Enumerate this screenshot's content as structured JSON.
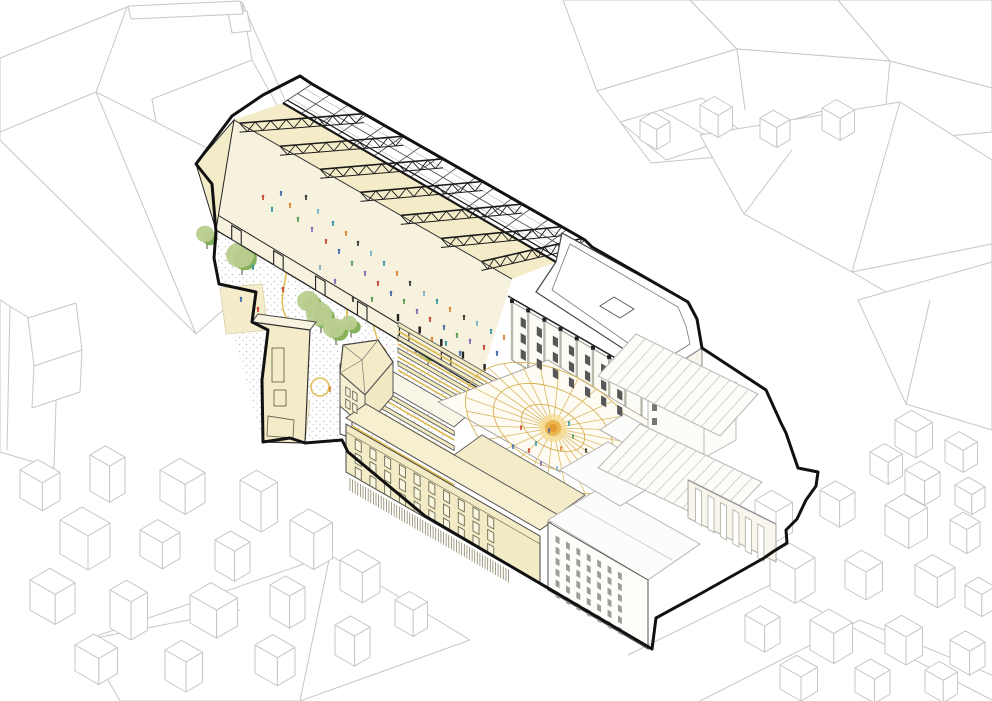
{
  "illustration": {
    "kind": "axonometric-architectural-cutaway",
    "subject": "market hall with open truss roof, public plaza, courtyard with radial canopy and theatre block inside a bold site boundary, surrounded by outline context buildings",
    "visible_text": "none"
  },
  "colors": {
    "ink": "#161616",
    "boundary": "#111111",
    "context_line": "#c7c7c7",
    "theatre_line": "#b8b8b8",
    "cream": "#f4ecc8",
    "cream_light": "#f8f3de",
    "cream_floor": "#f7f2dd",
    "facade_cream": "#f3ebc6",
    "window_frame": "#6a6a55",
    "window_dark": "#575757",
    "window_gray": "#9b9b9b",
    "stipple": "#c2c2c2",
    "tree_light": "#b9cd8f",
    "tree_dark": "#7fae53",
    "trunk": "#6b6b4f",
    "yellow": "#e3bf5c",
    "canopy": "#d8b052",
    "sun_core": "#e09a2f",
    "sun_mid": "#ecb64e",
    "sun_glow": "#f6dc8f"
  },
  "people_palette": [
    "#cc4b3b",
    "#3e9aa6",
    "#4a6fae",
    "#dd8a3a",
    "#5d9e56",
    "#3f3f3f",
    "#8a6fb2",
    "#7fb4c9"
  ],
  "people": {
    "market_hall": [
      [
        263,
        200
      ],
      [
        272,
        212
      ],
      [
        281,
        196
      ],
      [
        290,
        208
      ],
      [
        298,
        222
      ],
      [
        306,
        200
      ],
      [
        312,
        232
      ],
      [
        318,
        214
      ],
      [
        326,
        244
      ],
      [
        333,
        226
      ],
      [
        339,
        254
      ],
      [
        346,
        236
      ],
      [
        352,
        266
      ],
      [
        358,
        246
      ],
      [
        365,
        276
      ],
      [
        371,
        256
      ],
      [
        378,
        286
      ],
      [
        384,
        266
      ],
      [
        391,
        296
      ],
      [
        397,
        276
      ],
      [
        404,
        304
      ],
      [
        410,
        286
      ],
      [
        417,
        314
      ],
      [
        424,
        296
      ],
      [
        430,
        322
      ],
      [
        437,
        304
      ],
      [
        444,
        330
      ],
      [
        450,
        312
      ],
      [
        457,
        338
      ],
      [
        464,
        320
      ],
      [
        470,
        344
      ],
      [
        477,
        326
      ],
      [
        484,
        350
      ],
      [
        491,
        334
      ],
      [
        497,
        356
      ],
      [
        504,
        340
      ],
      [
        372,
        302
      ],
      [
        353,
        302
      ],
      [
        335,
        284
      ],
      [
        320,
        270
      ],
      [
        420,
        332
      ],
      [
        446,
        346
      ],
      [
        460,
        356
      ],
      [
        432,
        342
      ]
    ],
    "plaza": [
      [
        258,
        312
      ],
      [
        270,
        346
      ],
      [
        300,
        366
      ],
      [
        330,
        392
      ],
      [
        362,
        402
      ],
      [
        380,
        372
      ],
      [
        346,
        354
      ],
      [
        310,
        332
      ],
      [
        283,
        292
      ],
      [
        253,
        270
      ],
      [
        241,
        302
      ],
      [
        398,
        342
      ],
      [
        372,
        420
      ],
      [
        300,
        416
      ],
      [
        266,
        257
      ],
      [
        352,
        386
      ]
    ],
    "courtyard": [
      [
        521,
        430
      ],
      [
        536,
        446
      ],
      [
        549,
        433
      ],
      [
        561,
        451
      ],
      [
        573,
        439
      ],
      [
        586,
        453
      ],
      [
        541,
        466
      ],
      [
        557,
        471
      ],
      [
        529,
        453
      ],
      [
        569,
        426
      ],
      [
        513,
        449
      ],
      [
        581,
        468
      ]
    ]
  },
  "trees": [
    [
      233,
      212,
      12
    ],
    [
      242,
      257,
      14
    ],
    [
      207,
      236,
      9
    ],
    [
      310,
      303,
      11
    ],
    [
      321,
      316,
      13
    ],
    [
      336,
      330,
      11
    ],
    [
      416,
      341,
      10
    ],
    [
      428,
      352,
      9
    ],
    [
      351,
      325,
      8
    ],
    [
      412,
      333,
      7
    ]
  ],
  "yellow_markings": {
    "squiggles": [
      "M282,250 C296,272 272,298 288,320 C299,334 291,350 299,362",
      "M360,304 C378,316 370,338 386,350",
      "M430,354 C446,364 462,368 476,378"
    ],
    "circles": [
      [
        332,
        271,
        13
      ],
      [
        320,
        387,
        9
      ]
    ],
    "pole": [
      347,
      298,
      347,
      334
    ],
    "cone": [
      405,
      296,
      412,
      338
    ]
  },
  "hall": {
    "eave_a": [
      312,
      84
    ],
    "eave_b": [
      585,
      240
    ],
    "ridge_a": [
      283,
      103
    ],
    "ridge_b": [
      556,
      262
    ],
    "bearing_a": [
      234,
      120
    ],
    "bearing_b": [
      512,
      279
    ],
    "base_a": [
      216,
      230
    ],
    "base_b": [
      478,
      388
    ],
    "wallt_a": [
      216,
      214
    ],
    "wallt_b": [
      478,
      372
    ],
    "truss_bays": 7,
    "glass_lines": 15,
    "portals": [
      0.06,
      0.22,
      0.38,
      0.54,
      0.7,
      0.86
    ]
  },
  "canopy_dome": {
    "cx": 553,
    "cy": 428,
    "rot": 27,
    "rx": [
      34,
      64,
      94
    ],
    "ry": [
      20,
      38,
      56
    ],
    "spokes": 28
  },
  "facades": [
    {
      "name": "courtyard-north-range-windows",
      "o": [
        512,
        302
      ],
      "len": 150,
      "cols": 7,
      "rows": [
        10,
        26,
        42
      ],
      "w": 6,
      "h": 9,
      "pad": 10,
      "style": "dark"
    },
    {
      "name": "south-range-windows",
      "o": [
        350,
        432
      ],
      "len": 182,
      "cols": 10,
      "rows": [
        4,
        18,
        32
      ],
      "w": 7,
      "h": 10,
      "pad": 6,
      "style": "frame"
    },
    {
      "name": "corner-building-windows",
      "o": [
        344,
        382
      ],
      "len": 20,
      "cols": 2,
      "rows": [
        4,
        16
      ],
      "w": 5,
      "h": 8,
      "pad": 2,
      "style": "frame"
    },
    {
      "name": "white-residential-windows",
      "o": [
        553,
        530
      ],
      "len": 90,
      "cols": 7,
      "rows": [
        4,
        15,
        26,
        37,
        48,
        59
      ],
      "w": 4.5,
      "h": 6.5,
      "pad": 3,
      "style": "gray"
    }
  ],
  "ribbed_base": {
    "o": [
      350,
      478
    ],
    "len": 186,
    "h": 13,
    "spacing": 3
  },
  "colonnade": {
    "o": [
      692,
      486
    ],
    "len": 80,
    "cols": 6,
    "w": 7,
    "h": 34
  },
  "context_houses": {
    "bottom_left": [
      [
        20,
        470,
        1.6,
        28
      ],
      [
        90,
        455,
        1.4,
        36
      ],
      [
        160,
        470,
        1.8,
        30
      ],
      [
        240,
        480,
        1.5,
        40
      ],
      [
        60,
        520,
        2.0,
        34
      ],
      [
        140,
        530,
        1.6,
        26
      ],
      [
        215,
        540,
        1.4,
        30
      ],
      [
        290,
        520,
        1.7,
        36
      ],
      [
        30,
        580,
        1.8,
        30
      ],
      [
        110,
        590,
        1.5,
        38
      ],
      [
        190,
        595,
        1.9,
        28
      ],
      [
        270,
        585,
        1.4,
        32
      ],
      [
        340,
        560,
        1.6,
        30
      ],
      [
        75,
        645,
        1.7,
        26
      ],
      [
        165,
        650,
        1.5,
        30
      ],
      [
        255,
        645,
        1.6,
        28
      ],
      [
        335,
        625,
        1.4,
        30
      ],
      [
        395,
        600,
        1.3,
        26
      ]
    ],
    "bottom_right": [
      [
        755,
        500,
        1.5,
        30
      ],
      [
        820,
        490,
        1.4,
        26
      ],
      [
        885,
        505,
        1.7,
        30
      ],
      [
        950,
        520,
        1.2,
        24
      ],
      [
        770,
        555,
        1.8,
        34
      ],
      [
        845,
        560,
        1.5,
        28
      ],
      [
        915,
        565,
        1.6,
        30
      ],
      [
        965,
        585,
        1.2,
        22
      ],
      [
        745,
        615,
        1.4,
        26
      ],
      [
        810,
        620,
        1.7,
        30
      ],
      [
        885,
        625,
        1.5,
        28
      ],
      [
        950,
        640,
        1.4,
        24
      ],
      [
        780,
        665,
        1.5,
        24
      ],
      [
        855,
        668,
        1.4,
        24
      ],
      [
        925,
        670,
        1.3,
        22
      ]
    ],
    "right_mid": [
      [
        895,
        420,
        1.5,
        26
      ],
      [
        945,
        440,
        1.3,
        22
      ],
      [
        905,
        470,
        1.4,
        24
      ],
      [
        955,
        485,
        1.2,
        20
      ],
      [
        870,
        452,
        1.3,
        22
      ]
    ],
    "top_right": [
      [
        640,
        120,
        1.2,
        20
      ],
      [
        700,
        105,
        1.3,
        22
      ],
      [
        760,
        118,
        1.2,
        20
      ],
      [
        822,
        108,
        1.3,
        22
      ]
    ]
  }
}
